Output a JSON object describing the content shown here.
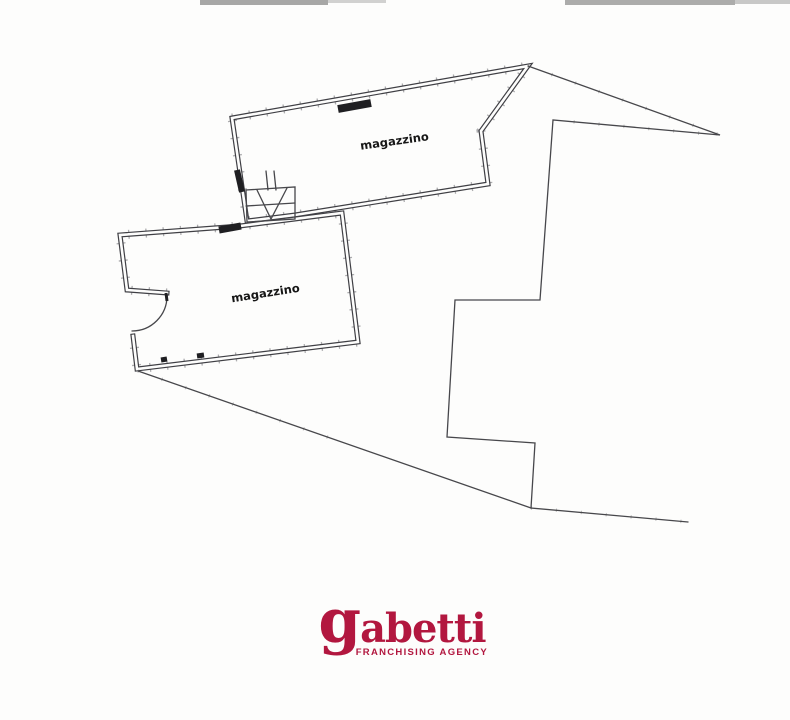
{
  "plan": {
    "rooms": [
      {
        "label": "magazzino"
      },
      {
        "label": "magazzino"
      }
    ],
    "wall_color": "#3f3f44",
    "line_color": "#47474b",
    "marking_color": "#1f1f22",
    "paper_color": "#fdfdfc"
  },
  "logo": {
    "wordmark": "gabetti",
    "subtitle": "FRANCHISING AGENCY",
    "brand_color": "#b2173f"
  }
}
